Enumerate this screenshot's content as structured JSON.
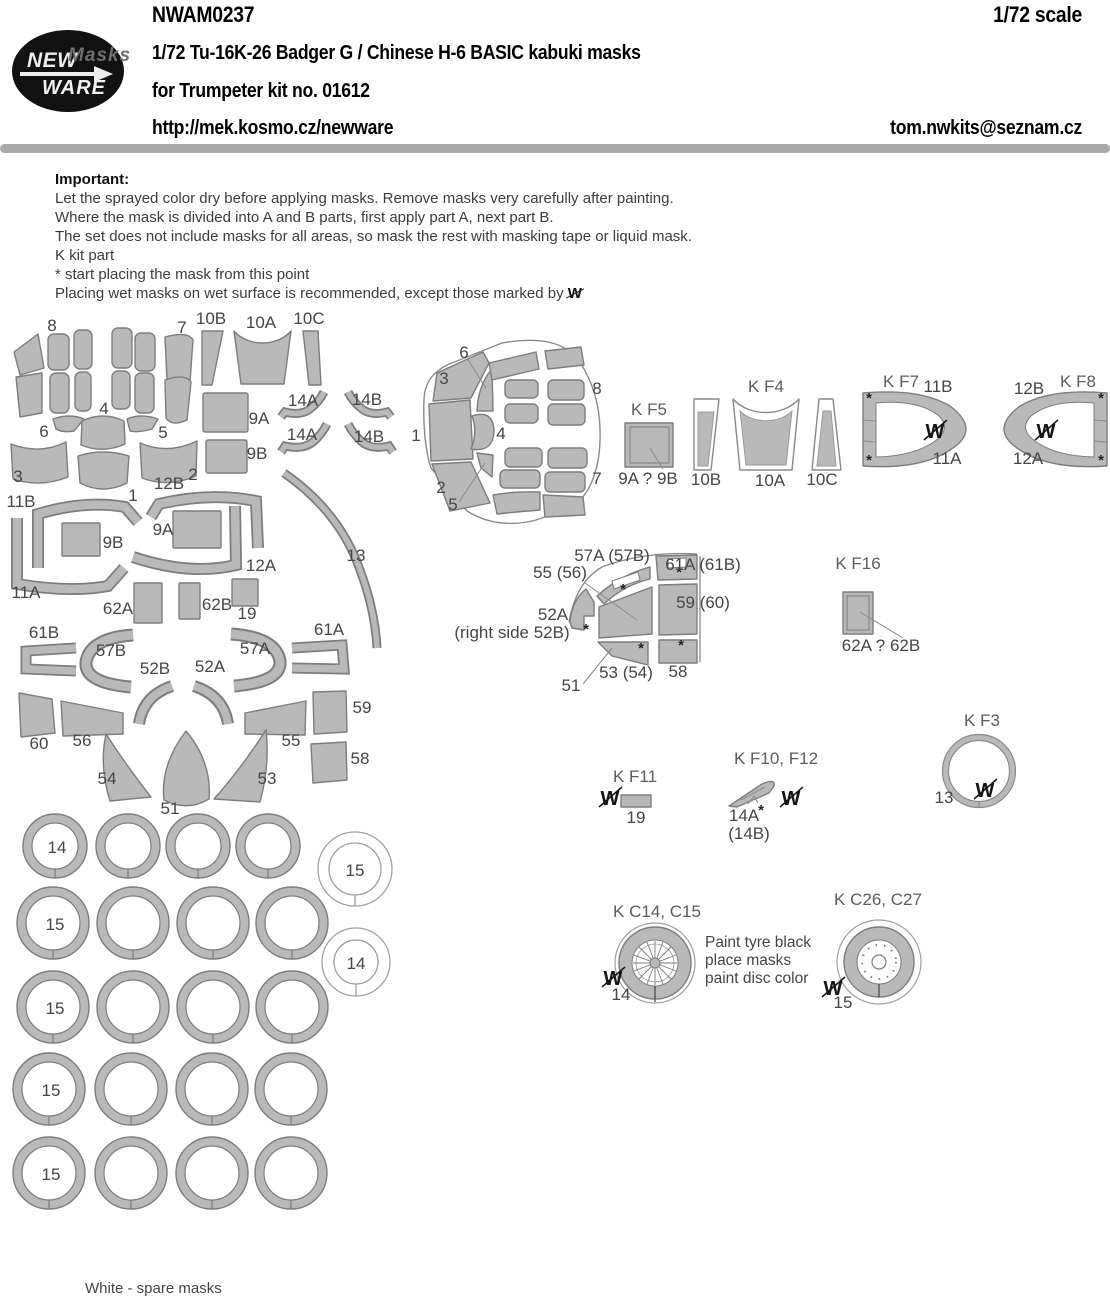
{
  "header": {
    "logo": {
      "line1": "NEW",
      "line2": "Masks",
      "line3": "WARE"
    },
    "product_code": "NWAM0237",
    "scale": "1/72 scale",
    "title_line1": "1/72 Tu-16K-26 Badger G / Chinese H-6 BASIC kabuki masks",
    "title_line2": "for Trumpeter kit no. 01612",
    "website": "http://mek.kosmo.cz/newware",
    "email": "tom.nwkits@seznam.cz"
  },
  "important": {
    "heading": "Important:",
    "line1": "Let the sprayed color dry before applying masks. Remove masks very carefully after painting.",
    "line2": "Where the mask is divided into A and B parts, first apply part A, next part B.",
    "line3": "The set does not include masks for all areas, so mask the rest with masking tape or liquid mask.",
    "line4": "K kit part",
    "line5": "*  start placing the mask from this point",
    "line6_prefix": "Placing wet masks on wet surface is recommended, except those marked by "
  },
  "symbols": {
    "crossed_w": "W",
    "star": "*"
  },
  "colors": {
    "mask_gray": "#b9b9b9",
    "outline_gray": "#7d7d7d",
    "bar_gray": "#a9a9a9"
  },
  "left_cluster": {
    "labels": [
      "8",
      "7",
      "10B",
      "10A",
      "10C",
      "4",
      "6",
      "5",
      "3",
      "2",
      "12B",
      "1",
      "9A",
      "9B",
      "14A",
      "14B",
      "14A",
      "14B",
      "11B",
      "9B",
      "9A",
      "12A",
      "11A",
      "13",
      "62A",
      "62B",
      "19",
      "61B",
      "57B",
      "57A",
      "61A",
      "52B",
      "52A",
      "60",
      "56",
      "55",
      "59",
      "58",
      "54",
      "51",
      "53"
    ]
  },
  "nose": {
    "labels": [
      "6",
      "3",
      "1",
      "2",
      "5",
      "4",
      "8",
      "7"
    ]
  },
  "groups": {
    "kf5": {
      "title": "K F5",
      "caption": "9A ? 9B"
    },
    "kf4": {
      "title": "K F4",
      "part1": "10B",
      "part2": "10A",
      "part3": "10C"
    },
    "kf7": {
      "title": "K F7",
      "top": "11B",
      "bottom": "11A"
    },
    "kf8": {
      "title": "K F8",
      "top": "12B",
      "bottom": "12A"
    },
    "kf16": {
      "title": "K F16",
      "caption": "62A ? 62B"
    },
    "kf11": {
      "title": "K F11",
      "part": "19"
    },
    "kf10f12": {
      "title": "K F10, F12",
      "part": "14A",
      "alt": "(14B)"
    },
    "kf3": {
      "title": "K F3",
      "part": "13"
    },
    "kc14c15": {
      "title": "K C14, C15",
      "part": "14"
    },
    "kc26c27": {
      "title": "K C26, C27",
      "part": "15"
    },
    "paint_note1": "Paint tyre black",
    "paint_note2": "place masks",
    "paint_note3": "paint disc color"
  },
  "fan": {
    "labels": [
      "57A (57B)",
      "55 (56)",
      "61A (61B)",
      "59 (60)",
      "52A",
      "(right side 52B)",
      "51",
      "53 (54)",
      "58"
    ]
  },
  "wheel_circles": {
    "row_labels": [
      "14",
      "15",
      "15",
      "15",
      "15"
    ],
    "spare_labels": [
      "15",
      "14"
    ]
  },
  "footer": {
    "note": "White - spare masks"
  }
}
